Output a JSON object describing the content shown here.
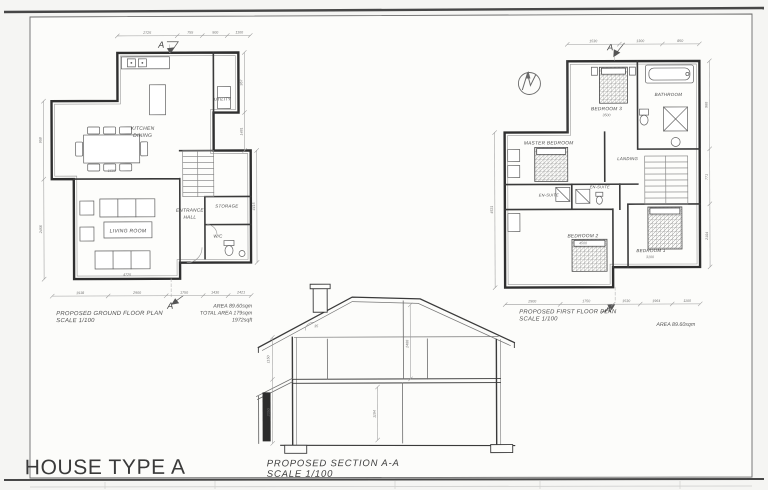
{
  "sheet": {
    "title": "HOUSE TYPE A"
  },
  "ground_floor": {
    "plan_title": "PROPOSED GROUND FLOOR PLAN",
    "plan_scale": "SCALE 1/100",
    "area_1": "AREA 89.60sqm",
    "area_2": "TOTAL AREA 179sqm",
    "area_3": "1972sqft",
    "marker": "A",
    "rooms": {
      "kitchen_1": "KITCHEN",
      "kitchen_2": "DINING",
      "utility": "UTILITY",
      "living": "LIVING ROOM",
      "entrance_1": "ENTRANCE",
      "entrance_2": "HALL",
      "storage": "STORAGE",
      "wc": "W/C"
    },
    "dims": {
      "top": [
        "2725",
        "755",
        "900",
        "1100"
      ],
      "bottom": [
        "1918",
        "2900",
        "1750",
        "1430",
        "2421"
      ],
      "left": [
        "958",
        "2456"
      ],
      "right": [
        "957",
        "1481",
        "4415"
      ],
      "living": "4725",
      "table": "1600"
    }
  },
  "first_floor": {
    "plan_title": "PROPOSED FIRST FLOOR PLAN",
    "plan_scale": "SCALE 1/100",
    "area_1": "AREA 89.60sqm",
    "marker": "A",
    "rooms": {
      "bedroom3": "BEDROOM 3",
      "bathroom": "BATHROOM",
      "master": "MASTER BEDROOM",
      "landing": "LANDING",
      "ensuite_left": "EN-SUITE",
      "ensuite_right": "EN-SUITE",
      "bedroom2": "BEDROOM 2",
      "bedroom1": "BEDROOM 1"
    },
    "dims": {
      "top": [
        "1530",
        "1300",
        "850"
      ],
      "bottom": [
        "2900",
        "1750",
        "1530",
        "1964",
        "1100"
      ],
      "right": [
        "960",
        "771",
        "2104"
      ],
      "left": [
        "4531"
      ],
      "bed3": "3500",
      "bed2": "4500",
      "bed1": "3100"
    }
  },
  "section_aa": {
    "title": "PROPOSED SECTION A-A",
    "scale": "SCALE 1/100",
    "dims": {
      "left_upper": "1150",
      "left_lower": "2350",
      "upper": "2400",
      "lower": "1194",
      "roof_angle": "35"
    }
  }
}
